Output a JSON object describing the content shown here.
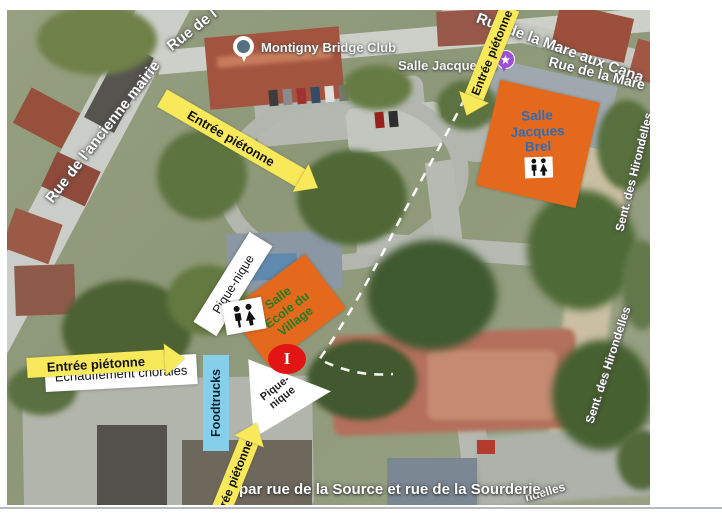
{
  "colors": {
    "arrow_yellow": "#f8e95a",
    "box_orange": "#e4691c",
    "brel_blue": "#2e6cb5",
    "ecole_green": "#1e7e24",
    "foodtrucks_blue": "#85cfeb",
    "info_red": "#e31414",
    "venue_purple": "#9d4fd6",
    "pin_teal": "#55707e",
    "dash_white": "#ffffff"
  },
  "streets": {
    "ancienne_mairie": "Rue de l'ancienne mairie",
    "rue_de_l": "Rue de l",
    "mare_aux_cana": "Rue de la Mare aux Cana",
    "rue_de_la_mare": "Rue de la Mare",
    "hirondelles_top": "Sent. des Hirondelles",
    "hirondelles_bottom": "Sent. des Hirondelles",
    "hirondelles_fragment": "ndelles"
  },
  "poi": {
    "bridge_club": "Montigny Bridge Club",
    "salle_jacques_label": "Salle Jacques B"
  },
  "arrows": {
    "entree_pietonne": "Entrée piétonne"
  },
  "boxes": {
    "echauffement": "Echauffement chorales",
    "pique_nique": "Pique-nique",
    "pique_nique_l1": "Pique-",
    "pique_nique_l2": "nique",
    "foodtrucks": "Foodtrucks",
    "salle_jacques_brel": {
      "l1": "Salle",
      "l2": "Jacques",
      "l3": "Brel"
    },
    "salle_ecole": {
      "l1": "Salle",
      "l2": "Ecole du",
      "l3": "Village"
    }
  },
  "markers": {
    "info": "I"
  },
  "banner": {
    "route": "par rue de la Source et rue de la Sourderie"
  }
}
